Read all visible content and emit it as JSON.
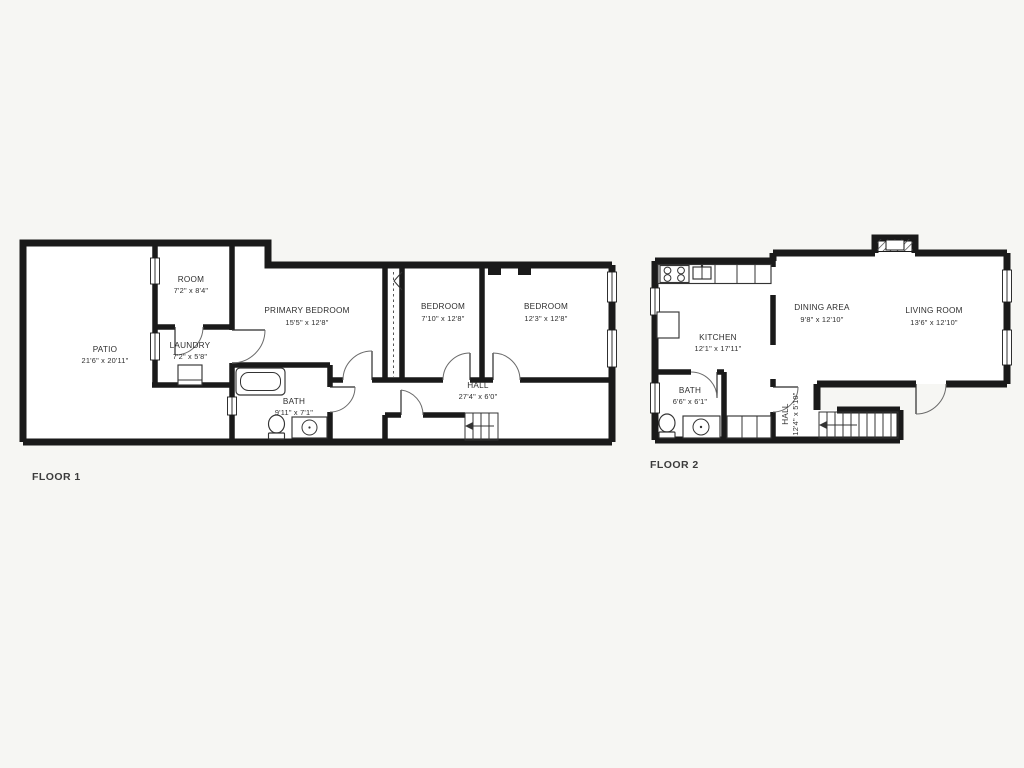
{
  "colors": {
    "background": "#f6f6f3",
    "wall": "#1a1a1a",
    "room_fill": "#ffffff",
    "label_text": "#2e2e2e"
  },
  "floor1": {
    "label": "FLOOR 1",
    "rooms": [
      {
        "name": "PATIO",
        "dims": "21'6\" x 20'11\""
      },
      {
        "name": "ROOM",
        "dims": "7'2\" x 8'4\""
      },
      {
        "name": "LAUNDRY",
        "dims": "7'2\" x 5'8\""
      },
      {
        "name": "PRIMARY BEDROOM",
        "dims": "15'5\" x 12'8\""
      },
      {
        "name": "BEDROOM",
        "dims": "7'10\" x 12'8\""
      },
      {
        "name": "BEDROOM",
        "dims": "12'3\" x 12'8\""
      },
      {
        "name": "BATH",
        "dims": "9'11\" x 7'1\""
      },
      {
        "name": "HALL",
        "dims": "27'4\" x 6'0\""
      }
    ]
  },
  "floor2": {
    "label": "FLOOR 2",
    "rooms": [
      {
        "name": "KITCHEN",
        "dims": "12'1\" x 17'11\""
      },
      {
        "name": "DINING AREA",
        "dims": "9'8\" x 12'10\""
      },
      {
        "name": "LIVING ROOM",
        "dims": "13'6\" x 12'10\""
      },
      {
        "name": "BATH",
        "dims": "6'6\" x 6'1\""
      },
      {
        "name": "HALL",
        "dims": "12'4\" x 5'10\""
      }
    ]
  }
}
